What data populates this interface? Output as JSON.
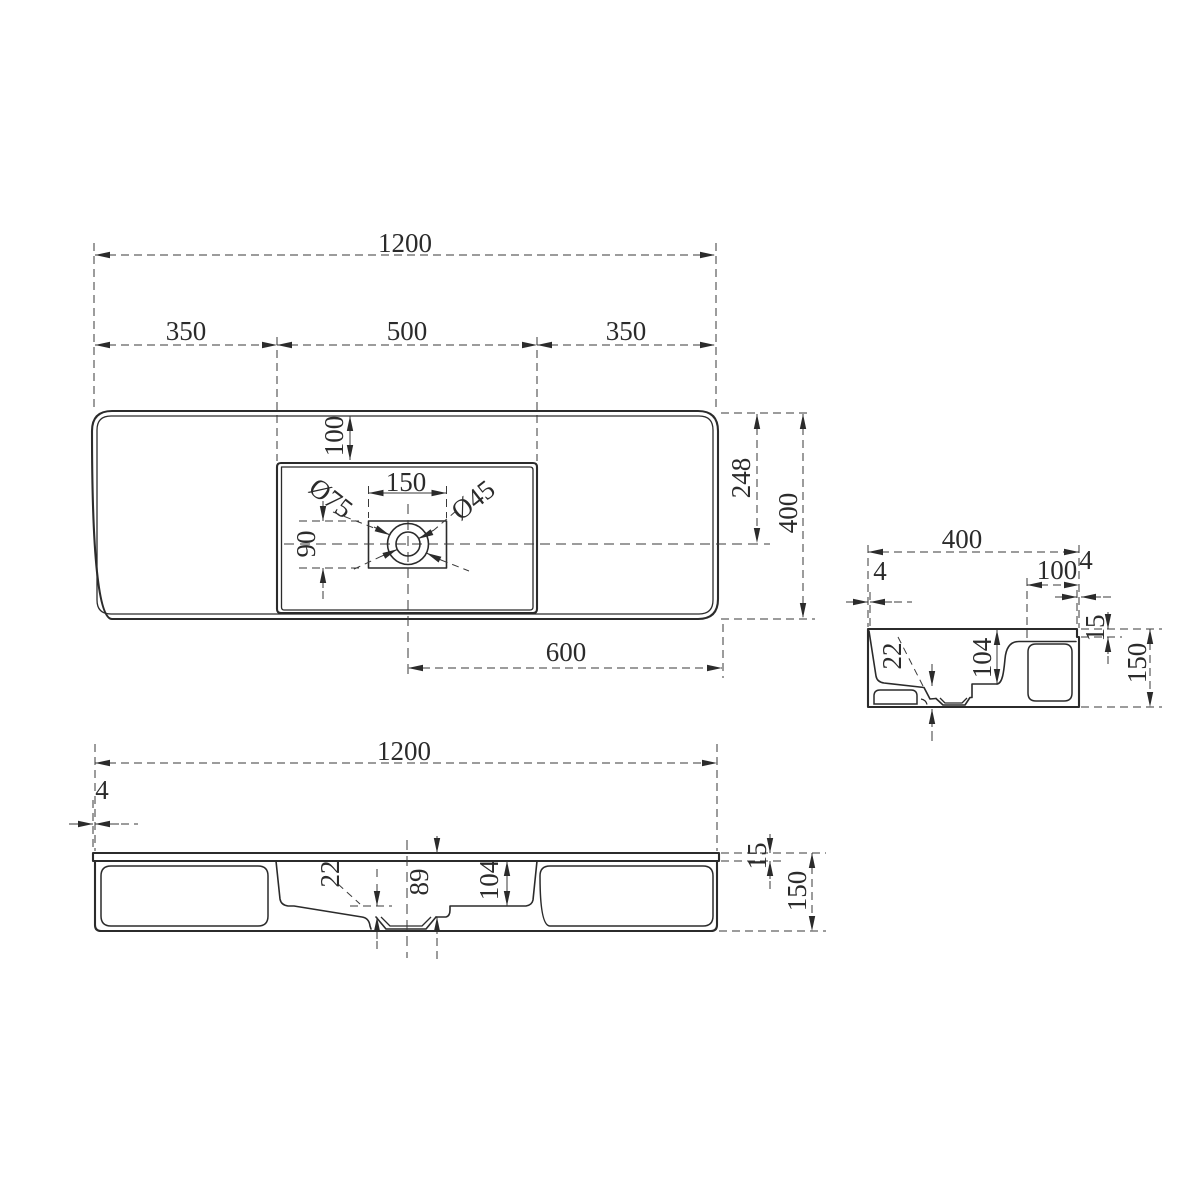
{
  "drawing": {
    "background": "#ffffff",
    "line_color": "#2b2b2b",
    "views": {
      "plan": "top-view",
      "side": "side-section-view",
      "front": "front-section-view"
    }
  },
  "dimensions": {
    "plan": {
      "overall_width": "1200",
      "left_segment": "350",
      "basin_width": "500",
      "right_segment": "350",
      "basin_top_inset": "100",
      "drain_cutout_width": "150",
      "faucet_hole_dia": "Ø75",
      "drain_hole_dia": "Ø45",
      "drain_cutout_height": "90",
      "center_offset": "248",
      "overall_depth": "400",
      "drain_to_right_edge": "600"
    },
    "side": {
      "overall_depth": "400",
      "front_lip": "4",
      "back_ledge_width": "100",
      "back_notch": "4",
      "slope_drop": "22",
      "bowl_depth": "104",
      "top_thickness": "15",
      "overall_height": "150"
    },
    "front": {
      "overall_width": "1200",
      "side_lip": "4",
      "slope_drop": "22",
      "drain_depth": "89",
      "bowl_depth": "104",
      "top_thickness": "15",
      "overall_height": "150"
    }
  }
}
